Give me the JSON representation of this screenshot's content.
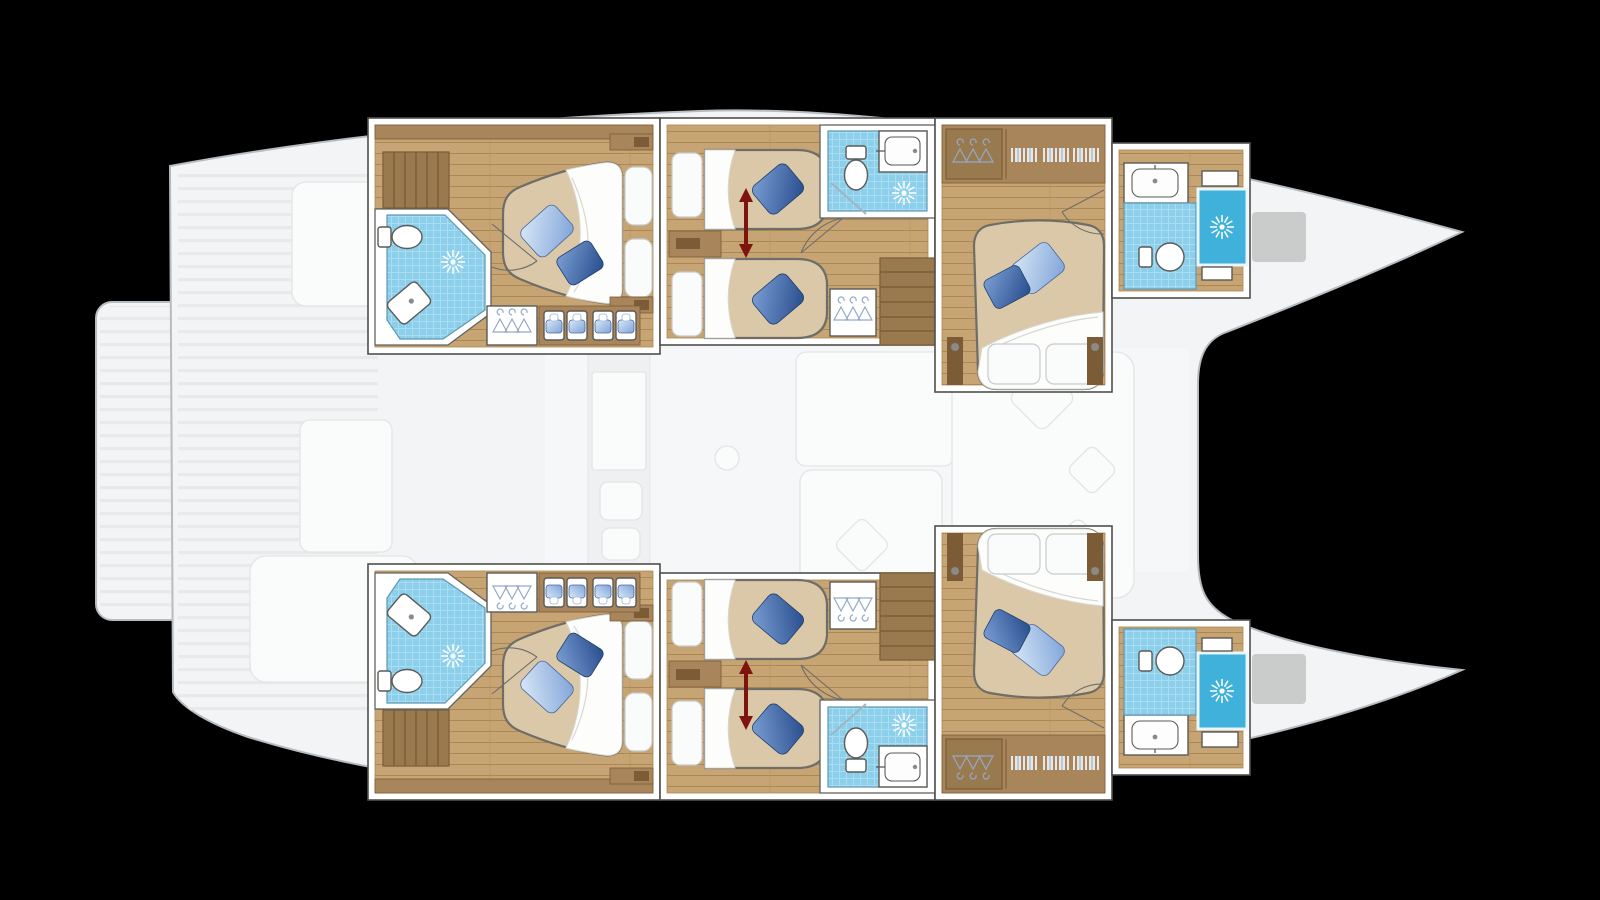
{
  "scene": {
    "type": "yacht-floor-plan",
    "subject": "catamaran accommodation layout, overhead view, bow pointing right",
    "layers": {
      "faded": "main deck (cockpit, swim platform, saloon, galley, foredeck) shown ghosted in light grey",
      "highlighted": "lower-deck cabins of both hulls shown in full colour with white wall borders"
    }
  },
  "rooms": [
    {
      "id": "port-aft-cabin",
      "name": "Port aft double cabin",
      "features": [
        "double bed",
        "2 blue cushions",
        "en-suite: shower, toilet, sink",
        "hanging wardrobe",
        "storage cubbies",
        "step bench"
      ]
    },
    {
      "id": "port-mid-cabin",
      "name": "Port midship twin cabin",
      "features": [
        "2 single beds",
        "convertible-bed red arrow",
        "en-suite: shower, toilet, sink counter",
        "hanging wardrobe",
        "companionway stairs"
      ]
    },
    {
      "id": "port-fwd-cabin",
      "name": "Port forward double cabin",
      "features": [
        "double bed",
        "2 blue cushions",
        "hanging wardrobe",
        "clothes shelves"
      ]
    },
    {
      "id": "port-fwd-bathroom",
      "name": "Port forward bathroom",
      "features": [
        "sink counter",
        "toilet",
        "separate shower cubicle",
        "shelves"
      ]
    },
    {
      "id": "starboard-aft-cabin",
      "name": "Starboard aft double cabin",
      "features": [
        "mirror of port aft cabin"
      ]
    },
    {
      "id": "starboard-mid-cabin",
      "name": "Starboard midship twin cabin",
      "features": [
        "mirror of port midship cabin"
      ]
    },
    {
      "id": "starboard-fwd-cabin",
      "name": "Starboard forward double cabin",
      "features": [
        "mirror of port forward cabin"
      ]
    },
    {
      "id": "starboard-fwd-bathroom",
      "name": "Starboard forward bathroom",
      "features": [
        "mirror of port forward bathroom"
      ]
    }
  ],
  "icons": [
    "shower-rose-icon",
    "toilet-icon",
    "sink-icon",
    "hanger-icon",
    "stairs-icon",
    "bed-convert-arrow",
    "towel-stack-icon",
    "steps-icon"
  ],
  "palette": {
    "bg": "#000000",
    "deck": "#f3f4f5",
    "deck-line": "#b7bcc0",
    "deck-slat": "#e7e9eb",
    "ghost-fill": "#fafbfb",
    "ghost-fill2": "#eef0f1",
    "ghost-line": "#e2e5e6",
    "wall": "#ffffff",
    "wall-stroke": "#4f4f4c",
    "bath-stroke": "#62625e",
    "wood-floor": "#c7a474",
    "wood-line": "#ad8752",
    "wood-furn": "#a8855a",
    "wood-dark": "#7c5c36",
    "wood-steps": "#997a4f",
    "mattress": "#dbc8a8",
    "outline": "#6e6d66",
    "duvet": "#fdfdfc",
    "duvet-line": "#d8d8d2",
    "pillow": "#fafbfb",
    "pillow-line": "#c7cbce",
    "tile": "#8bcfeb",
    "tile-line": "#aadcf2",
    "tile-edge": "#5f98b4",
    "shower": "#3fb1da",
    "fixture": "#5a5a56",
    "door": "#6d6d6a",
    "arrow": "#7d140d",
    "cushion-light-a": "#d9e9f8",
    "cushion-light-b": "#7fa3d8",
    "cushion-dark-a": "#7b9fd4",
    "cushion-dark-b": "#274c8c",
    "hanger": "#93a9c9",
    "hatch": "#a2a3a2"
  }
}
